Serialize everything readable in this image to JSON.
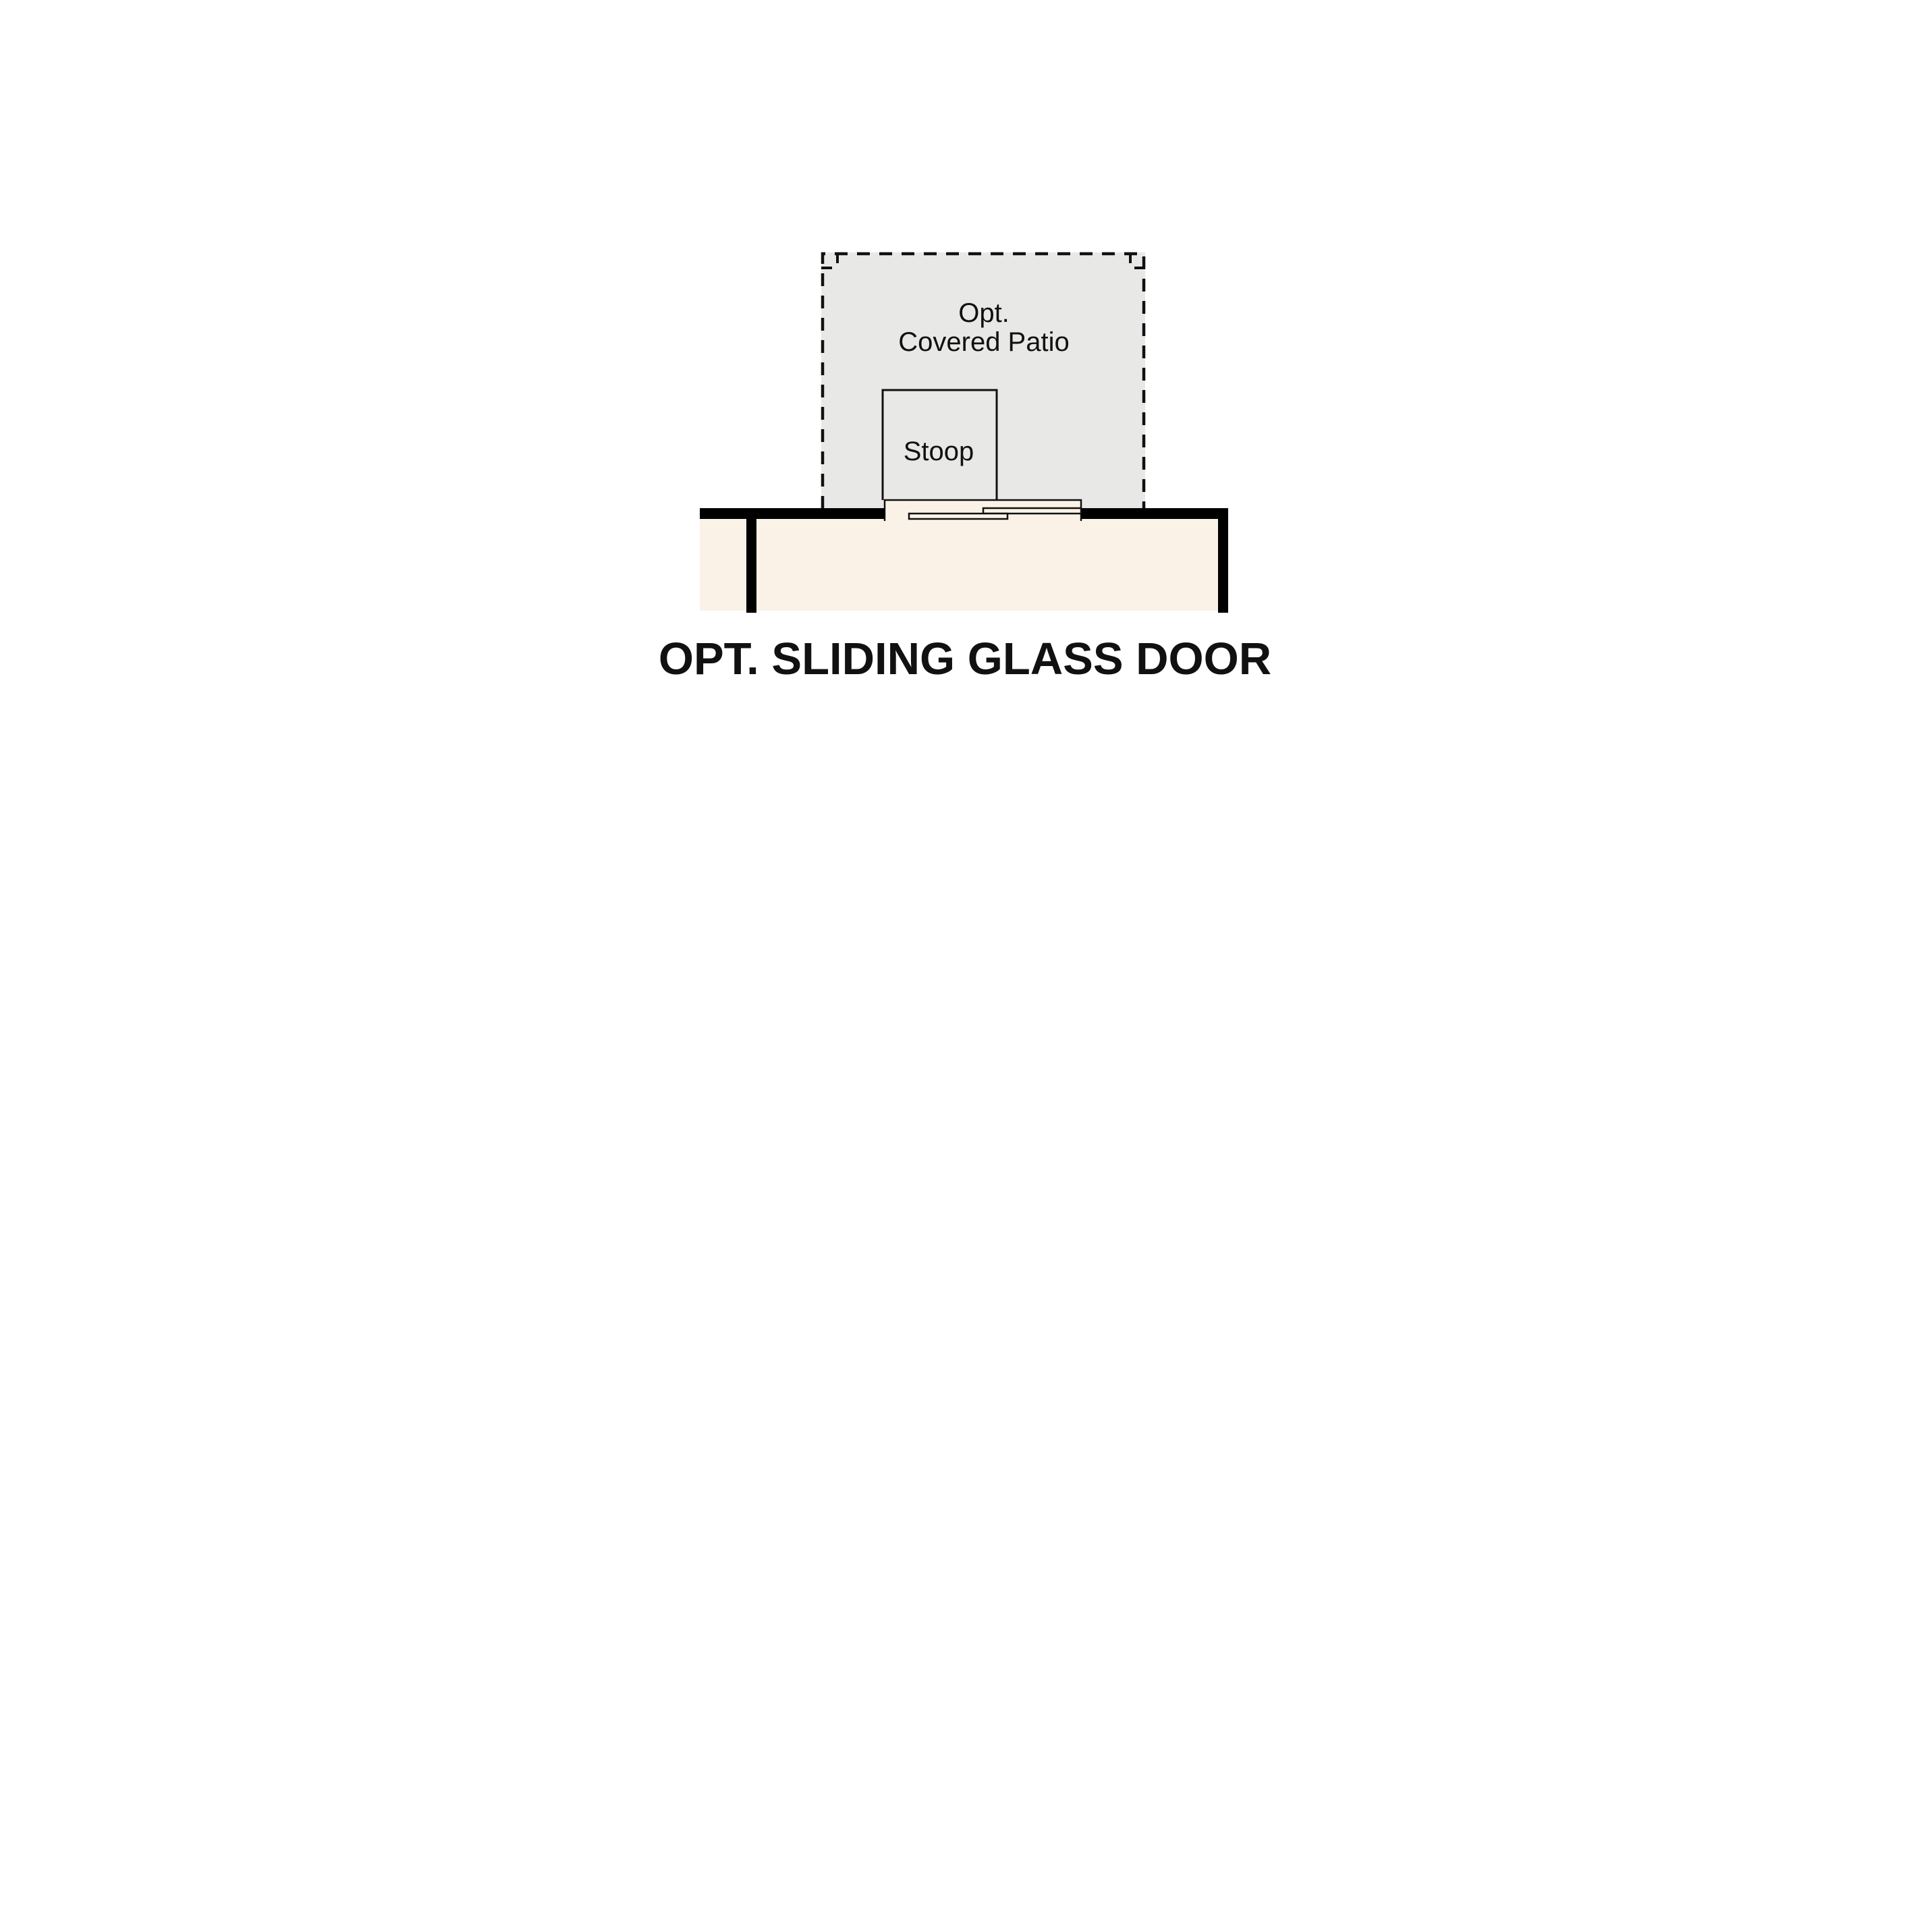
{
  "plan": {
    "patio": {
      "label_line1": "Opt.",
      "label_line2": "Covered Patio"
    },
    "stoop": {
      "label": "Stoop"
    },
    "caption": "OPT. SLIDING GLASS DOOR"
  },
  "colors": {
    "background": "#ffffff",
    "patio_fill": "#e8e8e6",
    "interior_fill": "#faf2e7",
    "wall": "#000000",
    "line": "#111111",
    "text": "#111111"
  }
}
